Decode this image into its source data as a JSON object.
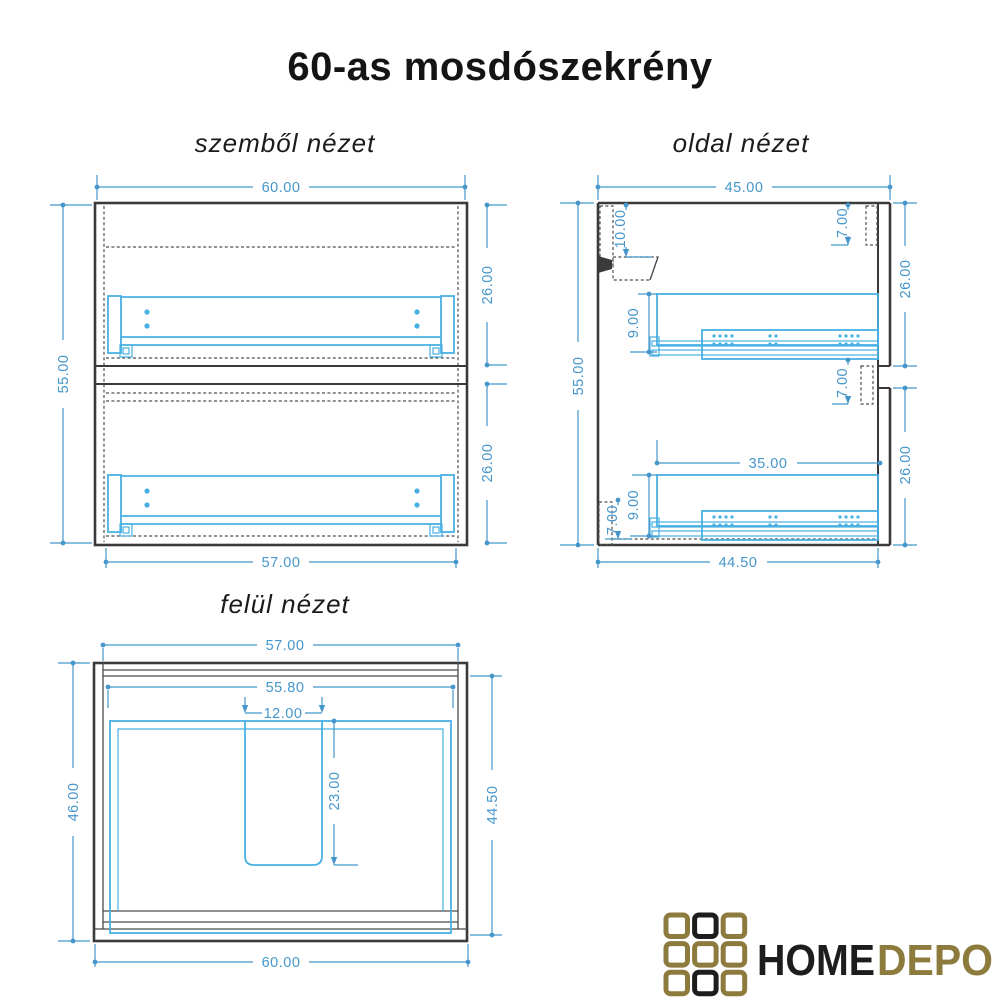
{
  "title": "60-as mosdószekrény",
  "views": {
    "front": {
      "label": "szemből nézet",
      "dims": {
        "width_top": "60.00",
        "height_left": "55.00",
        "drawer_upper_height": "26.00",
        "drawer_lower_height": "26.00",
        "width_bottom": "57.00"
      }
    },
    "side": {
      "label": "oldal nézet",
      "dims": {
        "depth_top": "45.00",
        "hanger_offset": "10.00",
        "gap_top": "7.00",
        "drawer_upper_height": "26.00",
        "rail_upper_height": "9.00",
        "gap_mid": "7.00",
        "rail_length": "35.00",
        "drawer_lower_height": "26.00",
        "rail_lower_height": "9.00",
        "gap_bottom": "7.00",
        "height_left": "55.00",
        "depth_bottom": "44.50"
      }
    },
    "top": {
      "label": "felül nézet",
      "dims": {
        "width_top": "57.00",
        "width_inner": "55.80",
        "cutout_width": "12.00",
        "depth_left": "46.00",
        "cutout_depth": "23.00",
        "depth_right": "44.50",
        "width_bottom": "60.00"
      }
    }
  },
  "logo": {
    "word_primary": "HOME",
    "word_secondary": "DEPO",
    "grid": [
      [
        "gold",
        "black",
        "gold"
      ],
      [
        "gold",
        "gold",
        "gold"
      ],
      [
        "gold",
        "black",
        "gold"
      ]
    ],
    "colors": {
      "gold": "#8d7b3e",
      "black": "#1d1d1d"
    }
  },
  "colors": {
    "dimension": "#4596cb",
    "hardware": "#47b0e3",
    "outline": "#3a3a3a",
    "title": "#141414",
    "background": "#ffffff"
  }
}
